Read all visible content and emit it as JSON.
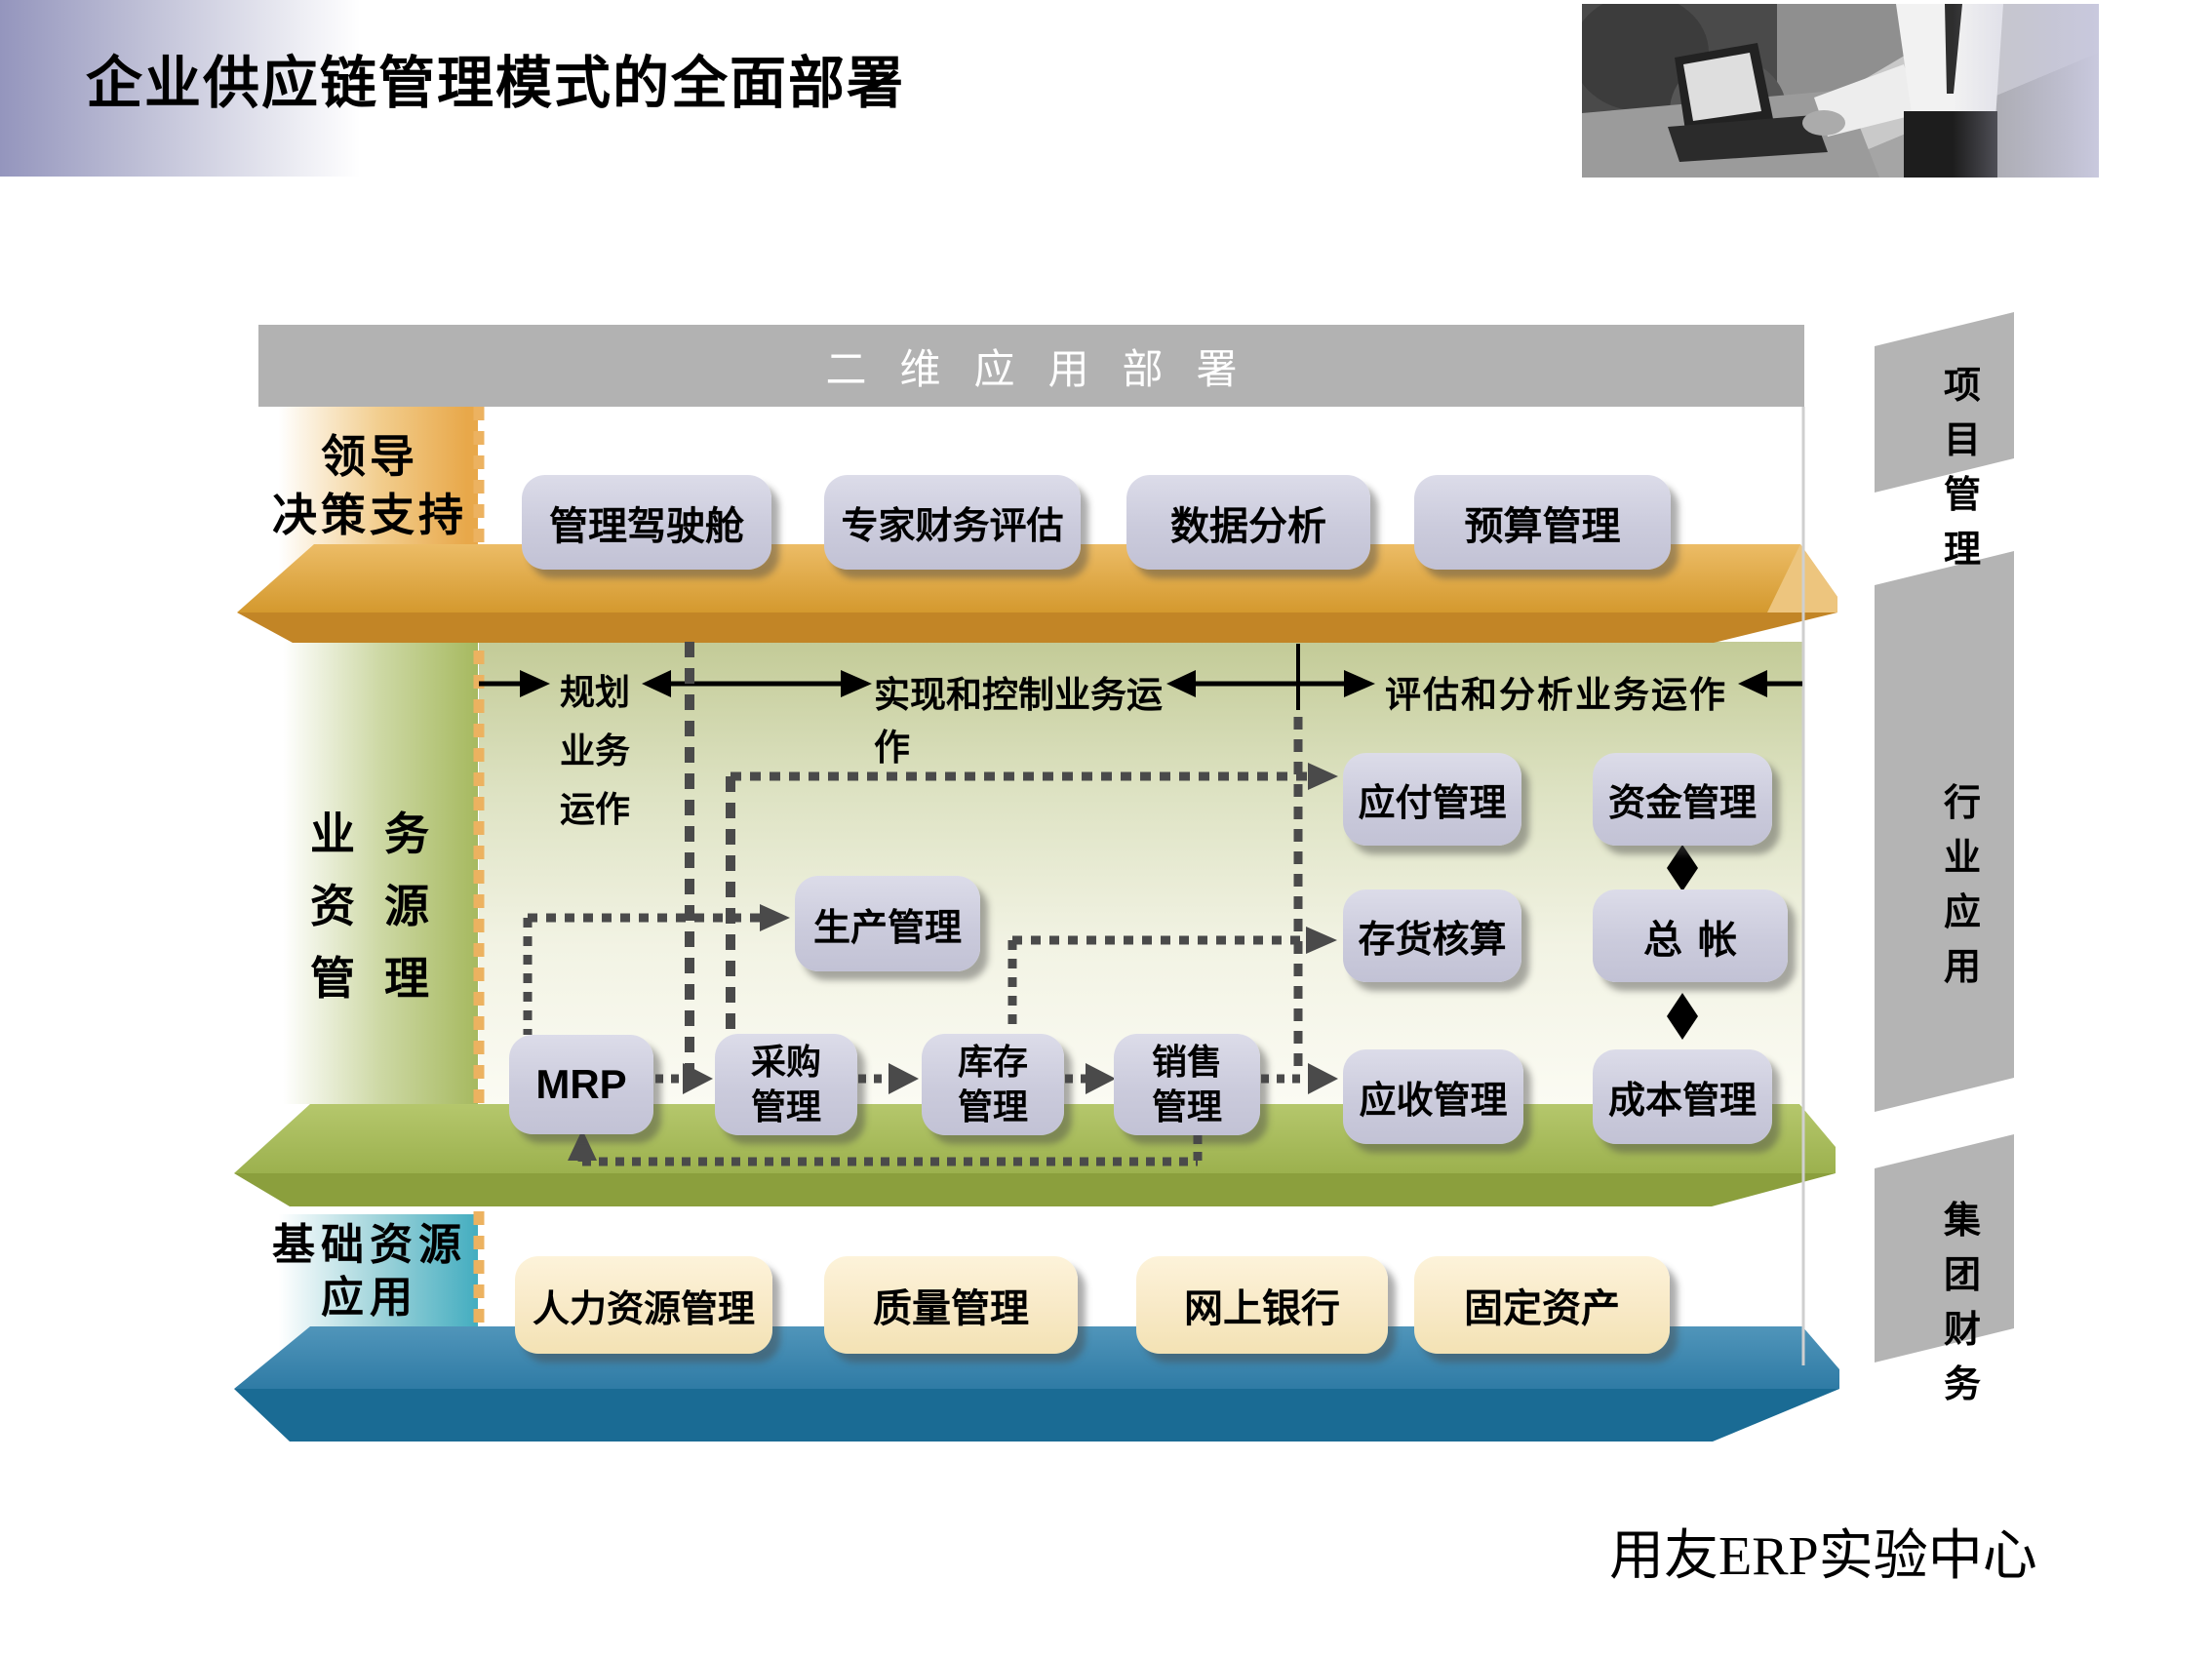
{
  "slide": {
    "title": "企业供应链管理模式的全面部署",
    "footer": "用友ERP实验中心"
  },
  "top_bar": {
    "label": "二维应用部署"
  },
  "side_panels": {
    "project": "项目\n管理",
    "industry": "行业\n应用",
    "group_finance": "集团\n财务"
  },
  "layers": {
    "leadership": {
      "label": "领导\n决策支持",
      "boxes": [
        "管理驾驶舱",
        "专家财务评估",
        "数据分析",
        "预算管理"
      ]
    },
    "business": {
      "label": "业务\n资源\n管理",
      "flow_labels": {
        "plan": "规划\n业务\n运作",
        "execute": "实现和控制业务运作",
        "evaluate": "评估和分析业务运作"
      },
      "boxes": {
        "mrp": "MRP",
        "purchase": "采购\n管理",
        "inventory": "库存\n管理",
        "sales": "销售\n管理",
        "production": "生产管理",
        "payable": "应付管理",
        "inventory_accounting": "存货核算",
        "receivable": "应收管理",
        "funds": "资金管理",
        "general_ledger": "总帐",
        "cost": "成本管理"
      }
    },
    "foundation": {
      "label": "基础资源\n应用",
      "boxes": [
        "人力资源管理",
        "质量管理",
        "网上银行",
        "固定资产"
      ]
    }
  },
  "colors": {
    "slab_orange_top": "#dda23a",
    "slab_orange_front": "#c28526",
    "slab_green_top": "#a9bd5b",
    "slab_green_front": "#8b9f3d",
    "slab_blue_top": "#3884ae",
    "slab_blue_front": "#1a6b94",
    "label_teal": "#43adc0",
    "panel_gray": "#b4b4b4",
    "bar_gray": "#b2b2b2",
    "box_lavender": "#cdcdde",
    "box_cream": "#f9ecc9",
    "dotted_gray": "#4a4a4a",
    "dashed_orange": "#ecb260",
    "header_purple": "#9495bd"
  }
}
